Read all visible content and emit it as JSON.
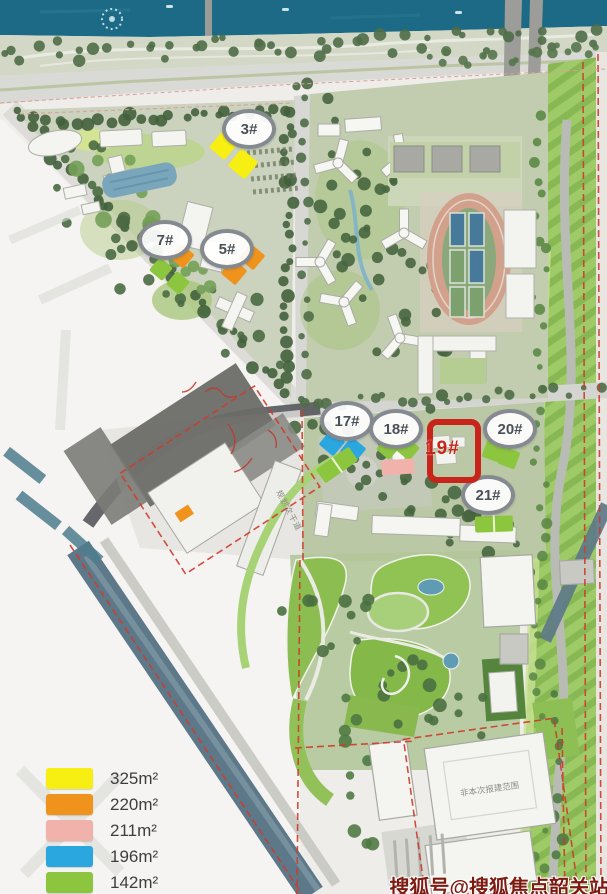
{
  "plan": {
    "badges": [
      {
        "id": "3",
        "label": "3#"
      },
      {
        "id": "7",
        "label": "7#"
      },
      {
        "id": "5",
        "label": "5#"
      },
      {
        "id": "17",
        "label": "17#"
      },
      {
        "id": "18",
        "label": "18#"
      },
      {
        "id": "20",
        "label": "20#"
      },
      {
        "id": "21",
        "label": "21#"
      }
    ],
    "highlight": {
      "label": "19#",
      "color": "#c9241a"
    },
    "annotations": {
      "road_label": "规划次干道",
      "building_note": "非本次报建范围"
    }
  },
  "legend": {
    "items": [
      {
        "name": "unit-325",
        "label": "325m²",
        "color": "#f7ee12"
      },
      {
        "name": "unit-220",
        "label": "220m²",
        "color": "#f0931c"
      },
      {
        "name": "unit-211",
        "label": "211m²",
        "color": "#f2b2ac"
      },
      {
        "name": "unit-196",
        "label": "196m²",
        "color": "#2ba7e0"
      },
      {
        "name": "unit-142",
        "label": "142m²",
        "color": "#8cc63f"
      }
    ]
  },
  "watermark": {
    "text": "搜狐号@搜狐焦点韶关站",
    "color": "#7d1b12"
  },
  "colors": {
    "yellow": "#f7ee12",
    "orange": "#f0931c",
    "pink": "#f2b2ac",
    "blue": "#2ba7e0",
    "green": "#8cc63f",
    "water": "#1c6a85",
    "river": "#5d7888",
    "boundary": "#cf3b2b"
  }
}
